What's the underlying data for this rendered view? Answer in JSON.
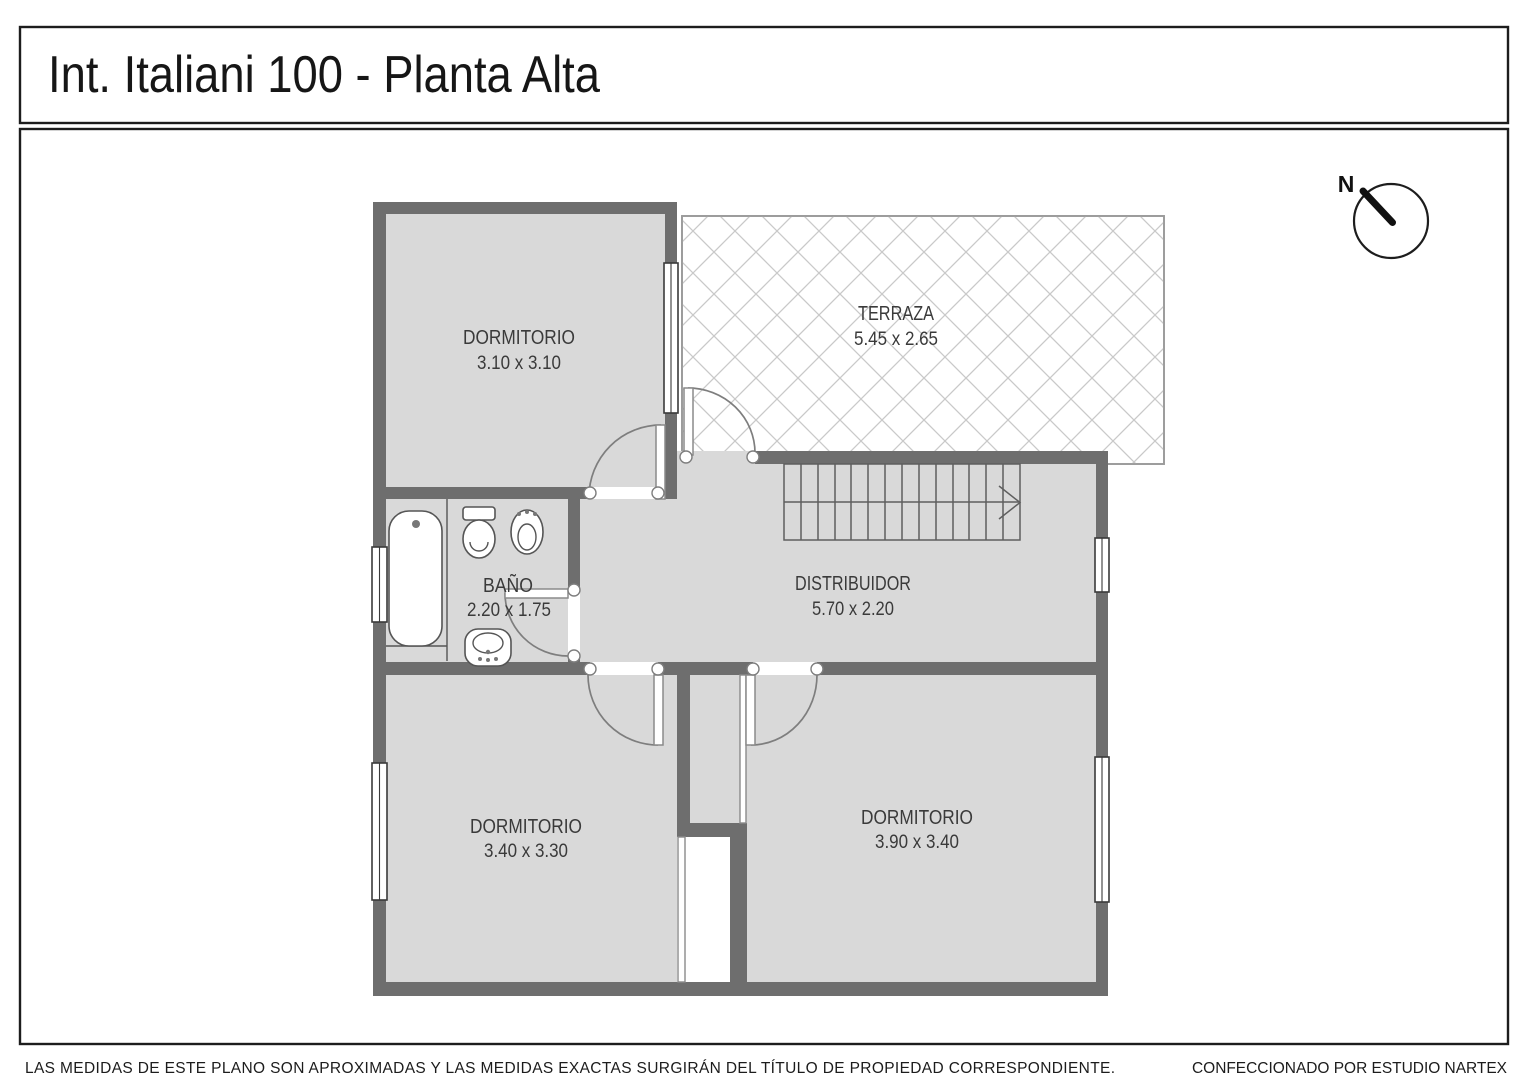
{
  "title": "Int. Italiani 100 - Planta Alta",
  "compass": {
    "north_label": "N"
  },
  "rooms": {
    "dormitorio1": {
      "name": "DORMITORIO",
      "dims": "3.10 x 3.10"
    },
    "terraza": {
      "name": "TERRAZA",
      "dims": "5.45 x 2.65"
    },
    "banio": {
      "name": "BAÑO",
      "dims": "2.20 x 1.75"
    },
    "distribuidor": {
      "name": "DISTRIBUIDOR",
      "dims": "5.70 x 2.20"
    },
    "dormitorio2": {
      "name": "DORMITORIO",
      "dims": "3.40 x 3.30"
    },
    "dormitorio3": {
      "name": "DORMITORIO",
      "dims": "3.90 x 3.40"
    }
  },
  "footer": {
    "left": "LAS MEDIDAS  DE ESTE PLANO SON APROXIMADAS Y LAS MEDIDAS EXACTAS SURGIRÁN DEL TÍTULO DE PROPIEDAD CORRESPONDIENTE.",
    "right": "CONFECCIONADO POR ESTUDIO NARTEX"
  },
  "colors": {
    "wall": "#6e6e6e",
    "floor": "#d9d9d9",
    "hatch": "#c9c9c9",
    "outline": "#1d1d1d",
    "label": "#3a3a3a"
  }
}
